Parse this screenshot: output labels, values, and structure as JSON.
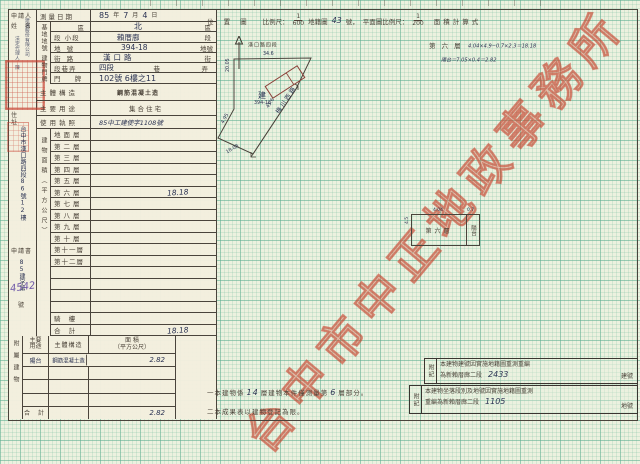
{
  "doc": {
    "watermark": "台中市中正地政事務所",
    "notes": {
      "n1_pre": "一本建物係",
      "n1_num": "14",
      "n1_mid": "層建物本件僅測量第",
      "n1_num2": "6",
      "n1_suf": "層部分。",
      "n2": "二本成果表以建物登記為限。"
    }
  },
  "form": {
    "applicant_label1": "申請人",
    "applicant_label2": "姓 名",
    "applicant_script1": "建設股份有限公司",
    "applicant_script2": "法定代理人．陳",
    "survey": {
      "label": "測量日期",
      "year": "85",
      "y_unit": "年",
      "month": "7",
      "m_unit": "月",
      "day": "4",
      "d_unit": "日"
    },
    "land_group": "基地地號",
    "land": [
      {
        "label": "區",
        "value": "北",
        "suffix": "區"
      },
      {
        "label": "段 小段",
        "value": "賴厝廍",
        "suffix": "段"
      },
      {
        "label": "地 號",
        "value": "394-18",
        "suffix": "地號"
      }
    ],
    "door_group": "建物門牌",
    "door": [
      {
        "label": "街 路",
        "value": "漢口路",
        "suffix": "街"
      },
      {
        "label": "段巷弄",
        "value": "四段",
        "suffix1": "巷",
        "suffix2": "弄"
      },
      {
        "label": "門 牌",
        "value": "102號 6樓之11",
        "suffix": ""
      }
    ],
    "structure": {
      "label": "主體構造",
      "value": "鋼筋混凝土造"
    },
    "usage": {
      "label": "主要用途",
      "value": "集合住宅"
    },
    "license": {
      "label": "使用執照",
      "value": "85中工建使字1108號"
    },
    "address": {
      "label": "住 址",
      "value": "台中市漢口路四段86號12樓"
    },
    "application": {
      "label": "申請書",
      "prefix": "85建字第",
      "number": "4542",
      "suffix": "號"
    },
    "area_col_label": "建物面積（平方公尺）",
    "floors": [
      {
        "label": "地面層",
        "value": ""
      },
      {
        "label": "第二層",
        "value": ""
      },
      {
        "label": "第三層",
        "value": ""
      },
      {
        "label": "第四層",
        "value": ""
      },
      {
        "label": "第五層",
        "value": ""
      },
      {
        "label": "第六層",
        "value": "18.18"
      },
      {
        "label": "第七層",
        "value": ""
      },
      {
        "label": "第八層",
        "value": ""
      },
      {
        "label": "第九層",
        "value": ""
      },
      {
        "label": "第十層",
        "value": ""
      },
      {
        "label": "第十一層",
        "value": ""
      },
      {
        "label": "第十二層",
        "value": ""
      },
      {
        "label": "",
        "value": ""
      },
      {
        "label": "",
        "value": ""
      },
      {
        "label": "",
        "value": ""
      },
      {
        "label": "",
        "value": ""
      },
      {
        "label": "騎 樓",
        "value": ""
      },
      {
        "label": "合 計",
        "value": "18.18"
      }
    ],
    "annex": {
      "group": "附屬建物",
      "header_use1": "主要",
      "header_use2": "用途",
      "header_structure": "主體構造",
      "header_area1": "面  積",
      "header_area2": "（平方公尺）",
      "rows": [
        {
          "use": "陽台",
          "structure": "鋼筋混凝土造",
          "area": "2.82"
        },
        {
          "use": "",
          "structure": "",
          "area": ""
        },
        {
          "use": "",
          "structure": "",
          "area": ""
        },
        {
          "use": "",
          "structure": "",
          "area": ""
        }
      ],
      "total_label": "合 計",
      "total": "2.82"
    }
  },
  "plot": {
    "header": {
      "title": "位 置 圖",
      "scale_label": "比例尺：",
      "scale_num": "1",
      "scale_den": "600",
      "cad_label": "地籍圖",
      "cad_no": "43",
      "cad_suffix": "號，",
      "plan_scale_label": "平面圖比例尺：",
      "plan_num": "1",
      "plan_den": "200",
      "calc_label": "面積計算式"
    },
    "location": {
      "street": "漢口路四段",
      "street_dim": "34.6",
      "parcel_mark": "建",
      "parcel_no": "394-18",
      "road": "梅川西路",
      "road_dim": "45.6",
      "dims": [
        "20.05",
        "4.95",
        "18.08"
      ]
    },
    "calc": {
      "line1_label": "第 六 層",
      "line1": "4.04×4.9−0.7×2.3＝18.18",
      "line2": "陽台＝7.05×0.4＝2.82"
    },
    "floorplan": {
      "main": "第六層",
      "balcony": "陽台",
      "dim_top": "4.04",
      "dim_top2": "0.7",
      "dim_left": "4.5"
    }
  },
  "remarks": [
    {
      "label": "附記",
      "line1": "本建物建號因實施地籍圖重測重編",
      "line2_pre": "為新賴厝廍二段",
      "number": "2433",
      "suffix": "建號"
    },
    {
      "label": "附記",
      "line1": "本建物坐落段別及地號因實施地籍圖重測",
      "line2_pre": "重編為新賴厝廍二段",
      "number": "1105",
      "suffix": "地號"
    }
  ]
}
